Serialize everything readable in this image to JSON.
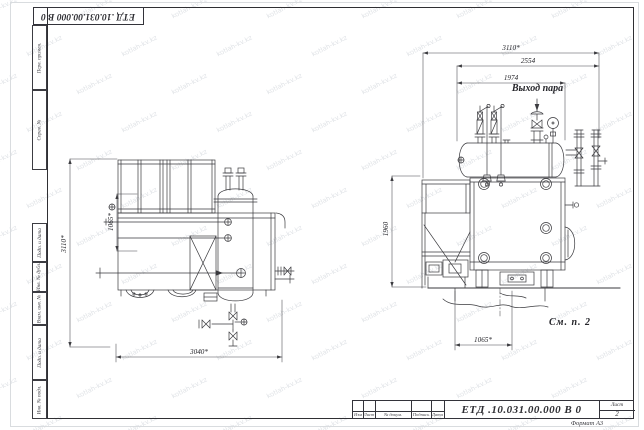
{
  "watermark": {
    "text": "kotlah-kv.kz"
  },
  "frame": {
    "stamp_rotated": "ЕТД .10.031.00.000  В 0",
    "format_note": "Формат А3",
    "margin_labels": [
      "Перв. примен.",
      "Справ. №",
      "Подп. и дата",
      "Инв. № дубл.",
      "Взам. инв. №",
      "Подп. и дата",
      "Инв. № подл."
    ]
  },
  "title_block": {
    "designation": "ЕТД .10.031.00.000  В 0",
    "columns": [
      "Изм",
      "Лист",
      "№ докум.",
      "Подпись",
      "Дата"
    ],
    "sheet_label": "Лист",
    "sheet_number": "2"
  },
  "drawing": {
    "left_view": {
      "dim_height": "3110*",
      "dim_inner": "1065*",
      "dim_width": "3040*"
    },
    "right_view": {
      "dim_overall": "3110*",
      "dim_drum": "2554",
      "dim_inner": "1974",
      "dim_height": "1960",
      "dim_pit_width": "1065*",
      "steam_outlet": "Выход пара",
      "note": "См. п. 2"
    }
  }
}
